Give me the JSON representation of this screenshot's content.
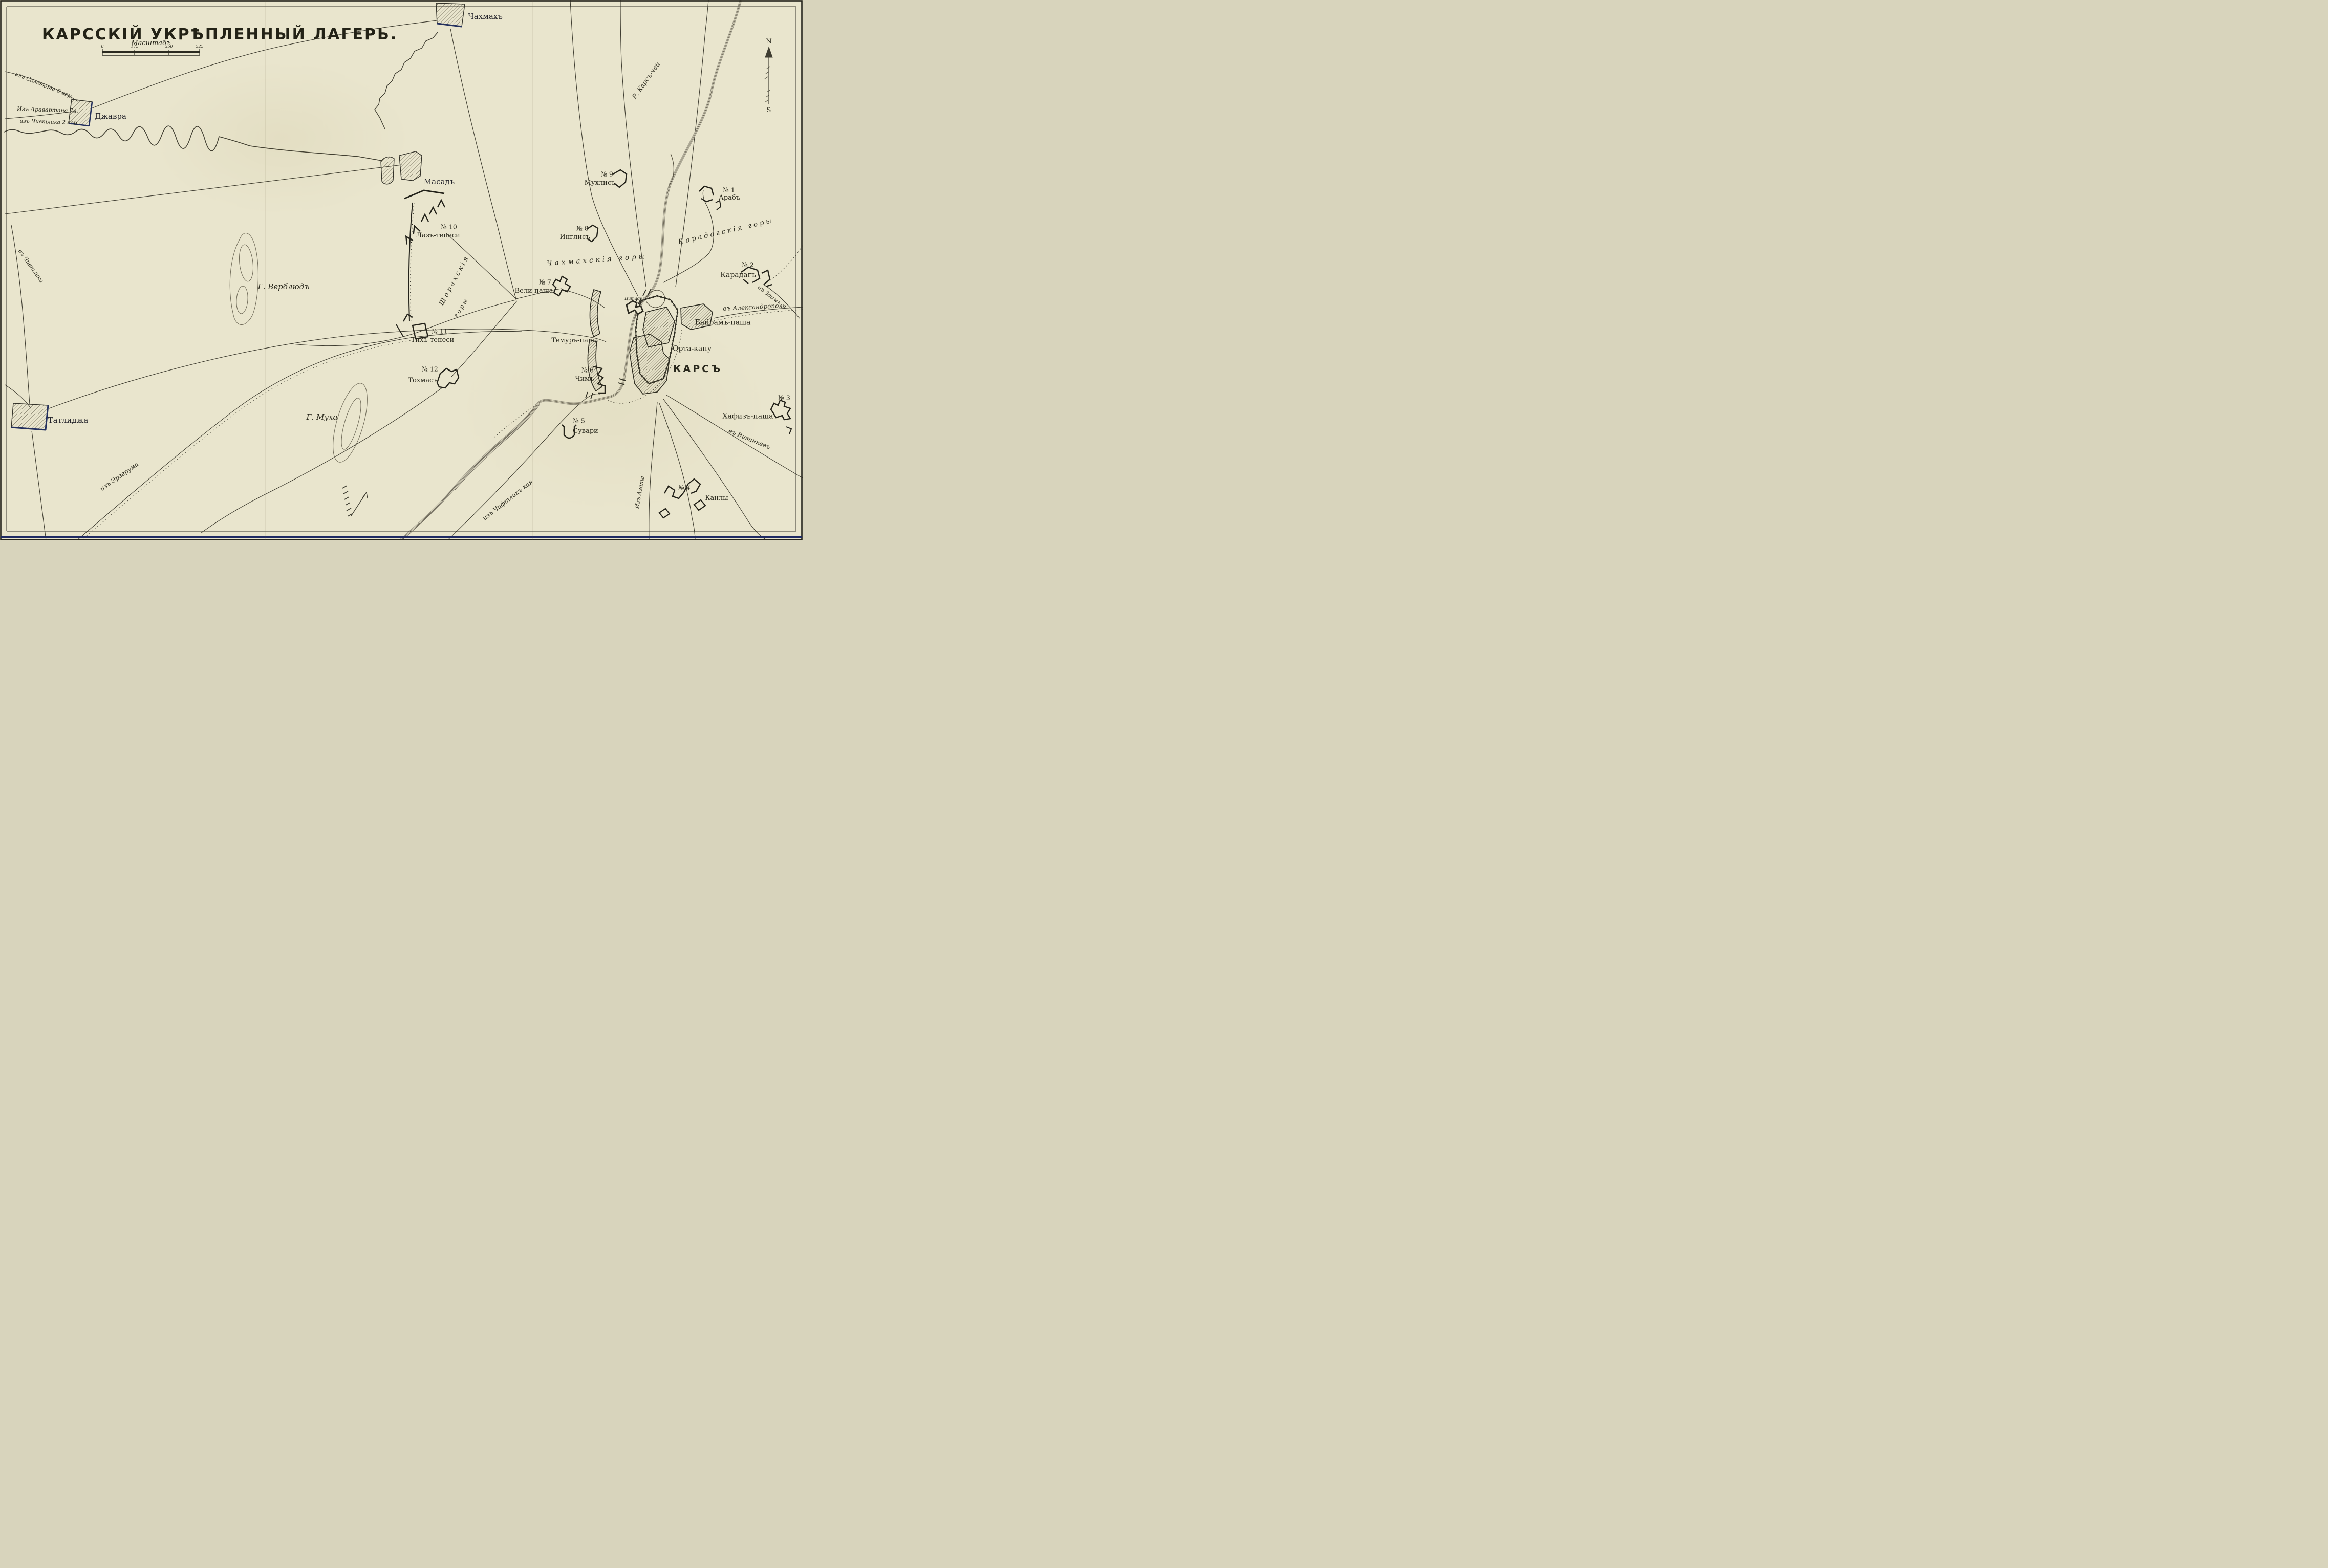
{
  "title": "КАРССКІЙ УКРѢПЛЕННЫЙ ЛАГЕРЬ.",
  "scale": {
    "label": "Масштабъ",
    "ticks": [
      "0",
      "175",
      "350",
      "525"
    ]
  },
  "compass": {
    "north": "N",
    "south": "S"
  },
  "river": {
    "name": "Р. Карсъ-чай"
  },
  "city": {
    "name": "КАРСЪ",
    "citadel": "Цитадель",
    "orta_kapu": "Орта-капу",
    "bairam": "Байрамъ-паша",
    "temur": "Темуръ-паша"
  },
  "settlements": [
    {
      "name": "Чахмахъ"
    },
    {
      "name": "Джавра"
    },
    {
      "name": "Масадъ"
    },
    {
      "name": "Татлиджа"
    }
  ],
  "forts": [
    {
      "no": "№ 1",
      "name": "Арабъ"
    },
    {
      "no": "№ 2",
      "name": "Карадагъ"
    },
    {
      "no": "№ 3",
      "name": "Хафизъ-паша"
    },
    {
      "no": "№ 4",
      "name": "Канлы"
    },
    {
      "no": "№ 5",
      "name": "Сувари"
    },
    {
      "no": "№ 6",
      "name": "Чимъ"
    },
    {
      "no": "№ 7",
      "name": "Вели-паша"
    },
    {
      "no": "№ 8",
      "name": "Инглисъ"
    },
    {
      "no": "№ 9",
      "name": "Мухлисъ"
    },
    {
      "no": "№ 10",
      "name": "Лазъ-тепеси"
    },
    {
      "no": "№ 11",
      "name": "Тихъ-тепеси"
    },
    {
      "no": "№ 12",
      "name": "Тохмасъ"
    }
  ],
  "mountains": {
    "shorakh_1": "Шорахскія",
    "shorakh_2": "горы",
    "chakhmakh": "Чахмахскія горы",
    "karadag": "Карадагскія горы"
  },
  "hills": {
    "verblud": "Г. Верблюдъ",
    "mukha": "Г. Муха"
  },
  "roads": {
    "samovat": "изъ Самовата 6 вер.",
    "aravartan": "Изъ Аравартана 7в.",
    "chivtlik2": "изъ Чивтлика 2 вер.",
    "chivtlik_w": "въ Чивтлика",
    "erzurum": "изъ Эрзерума",
    "chiftlik_kaya": "изъ Чифтликъ кая",
    "azat": "Изъ Азата",
    "vizinkev": "въ Визинкевъ",
    "alexandropol": "въ Александрополь",
    "zaim": "въ Заимъ"
  }
}
